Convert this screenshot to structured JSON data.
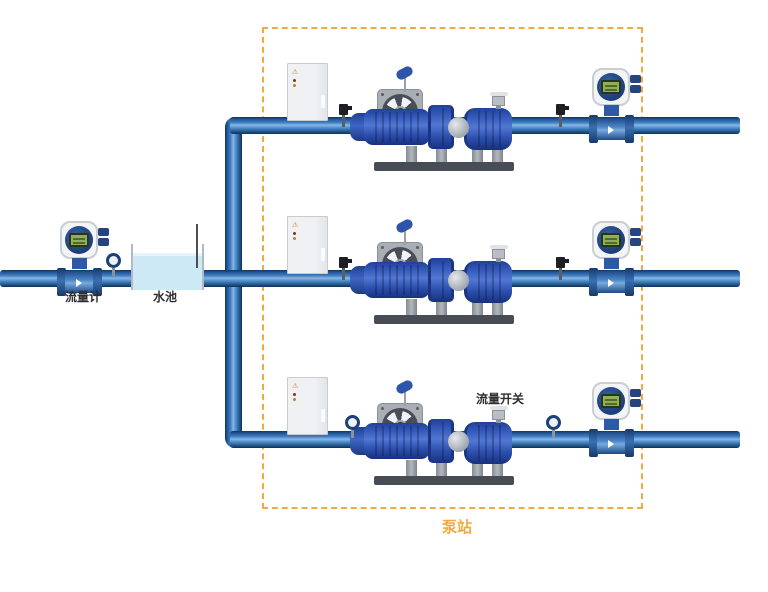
{
  "diagram_title": "pump-station-piping-diagram",
  "labels": {
    "flow_meter": "流量计",
    "water_pool": "水池",
    "flow_switch": "流量开关",
    "pump_station": "泵站",
    "warning_icon": "⚠"
  },
  "colors": {
    "pipe_dark": "#0f3460",
    "pipe_light": "#86b7e6",
    "pump_blue": "#2d56aa",
    "base_dark": "#474c55",
    "water_blue": "#cde9f6",
    "lcd_green": "#8fb054",
    "station_accent": "#f2a940"
  },
  "icons": {
    "flowmeter": "electromagnetic-flowmeter",
    "gauge": "pressure-gauge",
    "fan": "cooling-fan",
    "cabinet": "control-cabinet",
    "pump": "pump-motor-set",
    "sensor": "pipe-sensor"
  }
}
